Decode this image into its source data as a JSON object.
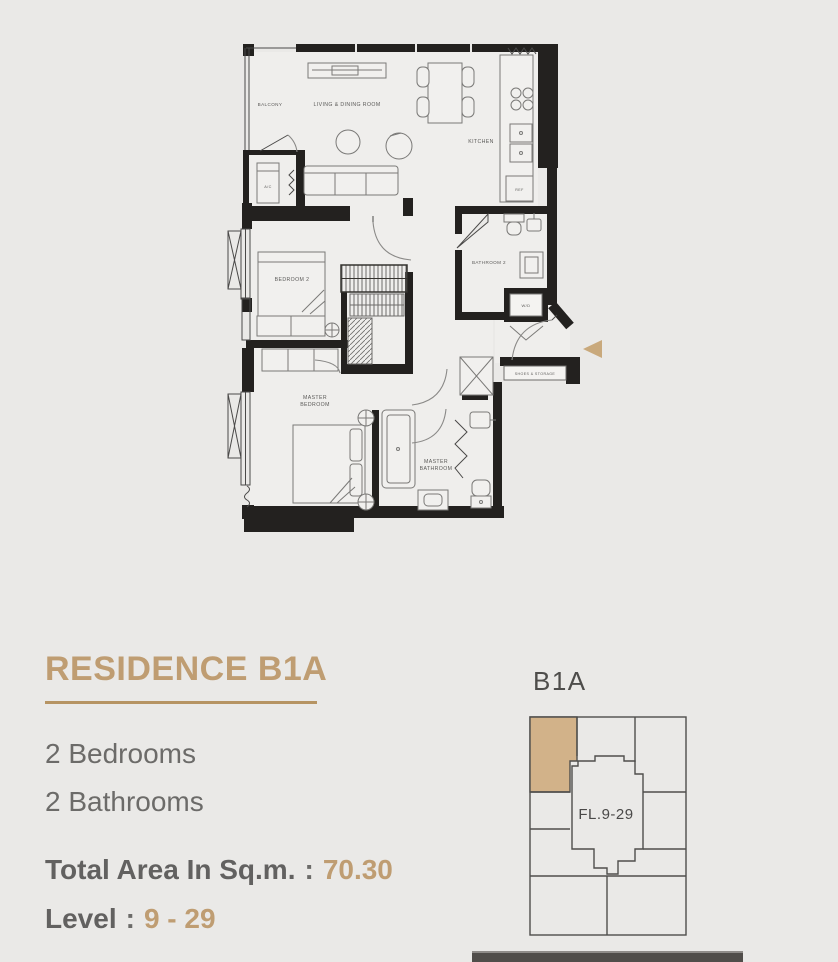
{
  "floor_plan": {
    "labels": {
      "balcony": "BALCONY",
      "living": "LIVING & DINING ROOM",
      "kitchen": "KITCHEN",
      "ac": "A/C",
      "ref": "REF",
      "bathroom2": "BATHROOM 2",
      "wd": "W/D",
      "shoes": "SHOES & STORAGE",
      "bedroom2": "BEDROOM 2",
      "master_bedroom_line1": "MASTER",
      "master_bedroom_line2": "BEDROOM",
      "master_bathroom_line1": "MASTER",
      "master_bathroom_line2": "BATHROOM"
    }
  },
  "info": {
    "title": "RESIDENCE B1A",
    "features": [
      "2 Bedrooms",
      "2 Bathrooms"
    ],
    "area_label": "Total Area In Sq.m.",
    "separator": ":",
    "area_value": "70.30",
    "level_label": "Level",
    "level_value": "9 - 29"
  },
  "key_plan": {
    "unit_label": "B1A",
    "floor_label": "FL.9-29"
  },
  "colors": {
    "accent": "#bf9d72",
    "highlight_unit": "#d2b289",
    "entry_arrow": "#c9a97c",
    "wall": "#23211f",
    "text_gray": "#6c6b69"
  }
}
